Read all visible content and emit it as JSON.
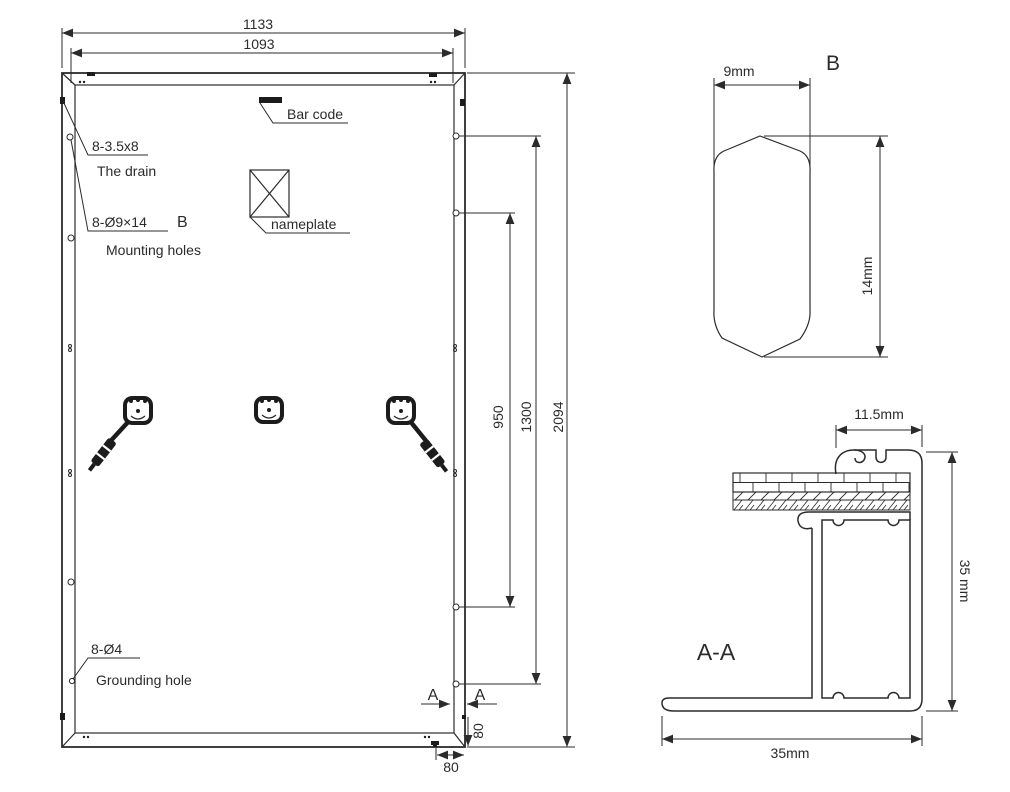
{
  "drawing": {
    "background": "#ffffff",
    "line_color": "#2b2b2b"
  },
  "rear_view": {
    "dim_width_outer": "1133",
    "dim_width_inner": "1093",
    "dim_height_full": "2094",
    "dim_holes_outer": "1300",
    "dim_holes_inner": "950",
    "dim_corner_vertical": "80",
    "dim_corner_horizontal": "80",
    "barcode_label": "Bar code",
    "nameplate_label": "nameplate",
    "drain_spec": "8-3.5x8",
    "drain_label": "The drain",
    "mounting_spec": "8-Ø9×14",
    "mounting_detail_ref": "B",
    "mounting_label": "Mounting holes",
    "grounding_spec": "8-Ø4",
    "grounding_label": "Grounding hole",
    "section_marker_left": "A",
    "section_marker_right": "A"
  },
  "detail_b": {
    "title": "B",
    "dim_width": "9mm",
    "dim_height": "14mm"
  },
  "section_aa": {
    "title": "A-A",
    "dim_clamp": "11.5mm",
    "dim_height": "35 mm",
    "dim_width": "35mm"
  }
}
